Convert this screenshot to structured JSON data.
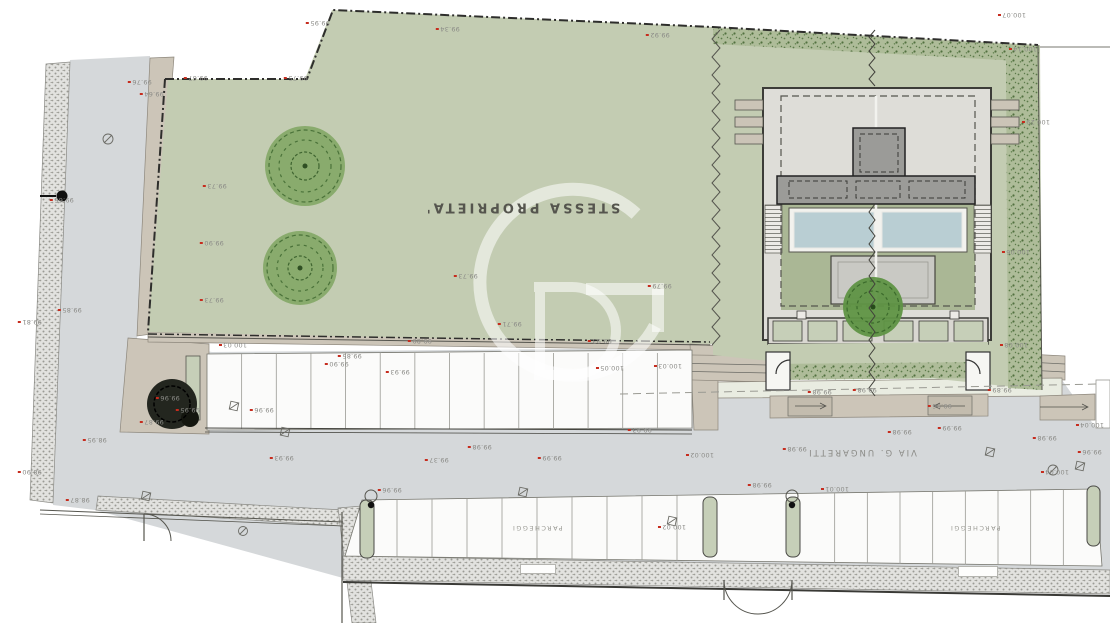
{
  "plan": {
    "property_label": "STESSA PROPRIETA'",
    "street_label": "VIA  G. UNGARETTI",
    "parking_label_left": "PARCHEGGI",
    "parking_label_right": "PARCHEGGI"
  },
  "watermark": {
    "name": "GD-logo"
  },
  "parking": {
    "upper_stalls": 14,
    "lower_left_stalls": 10,
    "lower_right_stalls": 9
  },
  "colors": {
    "lawn": "#c3ccb2",
    "road": "#d5d8da",
    "hedge_base": "#aebc99",
    "beige": "#ccc5b8",
    "walk": "#e9ece1",
    "terrace": "#deddd8",
    "building_dark": "#9b9b98",
    "pool": "#b9ced3",
    "stall_white": "#fbfbfa",
    "planter_green": "#c6cfb8",
    "tree_green": "#6f9c55",
    "label_gray": "#8b8b87",
    "marker_red": "#c62c1e",
    "boundary": "#2e2e2c"
  },
  "spot_elevations": [
    {
      "t": "99.95",
      "x": 318,
      "y": 23
    },
    {
      "t": "99.34",
      "x": 448,
      "y": 29
    },
    {
      "t": "99.92",
      "x": 658,
      "y": 35
    },
    {
      "t": "100.07",
      "x": 1012,
      "y": 15
    },
    {
      "t": "100.14",
      "x": 1023,
      "y": 49
    },
    {
      "t": "100.29",
      "x": 1036,
      "y": 122
    },
    {
      "t": "100.06",
      "x": 1016,
      "y": 252
    },
    {
      "t": "100.08",
      "x": 1014,
      "y": 345
    },
    {
      "t": "99.67",
      "x": 196,
      "y": 78
    },
    {
      "t": "99.75",
      "x": 296,
      "y": 78
    },
    {
      "t": "99.76",
      "x": 140,
      "y": 82
    },
    {
      "t": "99.64",
      "x": 152,
      "y": 94
    },
    {
      "t": "99.66",
      "x": 62,
      "y": 200
    },
    {
      "t": "99.85",
      "x": 70,
      "y": 310
    },
    {
      "t": "99.81",
      "x": 30,
      "y": 322
    },
    {
      "t": "98.95",
      "x": 95,
      "y": 440
    },
    {
      "t": "98.90",
      "x": 30,
      "y": 472
    },
    {
      "t": "98.87",
      "x": 78,
      "y": 500
    },
    {
      "t": "99.73",
      "x": 215,
      "y": 186
    },
    {
      "t": "99.90",
      "x": 212,
      "y": 243
    },
    {
      "t": "99.73",
      "x": 212,
      "y": 300
    },
    {
      "t": "99.73",
      "x": 466,
      "y": 276
    },
    {
      "t": "99.79",
      "x": 660,
      "y": 286
    },
    {
      "t": "99.71",
      "x": 510,
      "y": 324
    },
    {
      "t": "100.03",
      "x": 233,
      "y": 345
    },
    {
      "t": "99.89",
      "x": 420,
      "y": 341
    },
    {
      "t": "99.93",
      "x": 600,
      "y": 341
    },
    {
      "t": "99.85",
      "x": 350,
      "y": 356
    },
    {
      "t": "99.90",
      "x": 337,
      "y": 364
    },
    {
      "t": "99.93",
      "x": 398,
      "y": 372
    },
    {
      "t": "99.96",
      "x": 168,
      "y": 398
    },
    {
      "t": "99.95",
      "x": 188,
      "y": 410
    },
    {
      "t": "99.87",
      "x": 152,
      "y": 422
    },
    {
      "t": "99.96",
      "x": 262,
      "y": 410
    },
    {
      "t": "100.05",
      "x": 610,
      "y": 368
    },
    {
      "t": "100.03",
      "x": 668,
      "y": 366
    },
    {
      "t": "99.93",
      "x": 640,
      "y": 430
    },
    {
      "t": "99.93",
      "x": 282,
      "y": 458
    },
    {
      "t": "99.37",
      "x": 437,
      "y": 460
    },
    {
      "t": "99.98",
      "x": 480,
      "y": 447
    },
    {
      "t": "99.99",
      "x": 550,
      "y": 458
    },
    {
      "t": "100.02",
      "x": 700,
      "y": 455
    },
    {
      "t": "99.98",
      "x": 795,
      "y": 449
    },
    {
      "t": "99.98",
      "x": 900,
      "y": 432
    },
    {
      "t": "99.99",
      "x": 950,
      "y": 428
    },
    {
      "t": "99.98",
      "x": 1045,
      "y": 438
    },
    {
      "t": "100.04",
      "x": 1055,
      "y": 472
    },
    {
      "t": "99.96",
      "x": 1090,
      "y": 452
    },
    {
      "t": "100.02",
      "x": 672,
      "y": 527
    },
    {
      "t": "99.96",
      "x": 390,
      "y": 490
    },
    {
      "t": "99.98",
      "x": 820,
      "y": 392
    },
    {
      "t": "99.98",
      "x": 865,
      "y": 390
    },
    {
      "t": "99.96",
      "x": 940,
      "y": 406
    },
    {
      "t": "99.89",
      "x": 1000,
      "y": 390
    },
    {
      "t": "100.01",
      "x": 835,
      "y": 489
    },
    {
      "t": "99.98",
      "x": 760,
      "y": 485
    },
    {
      "t": "100.04",
      "x": 1090,
      "y": 425
    }
  ]
}
